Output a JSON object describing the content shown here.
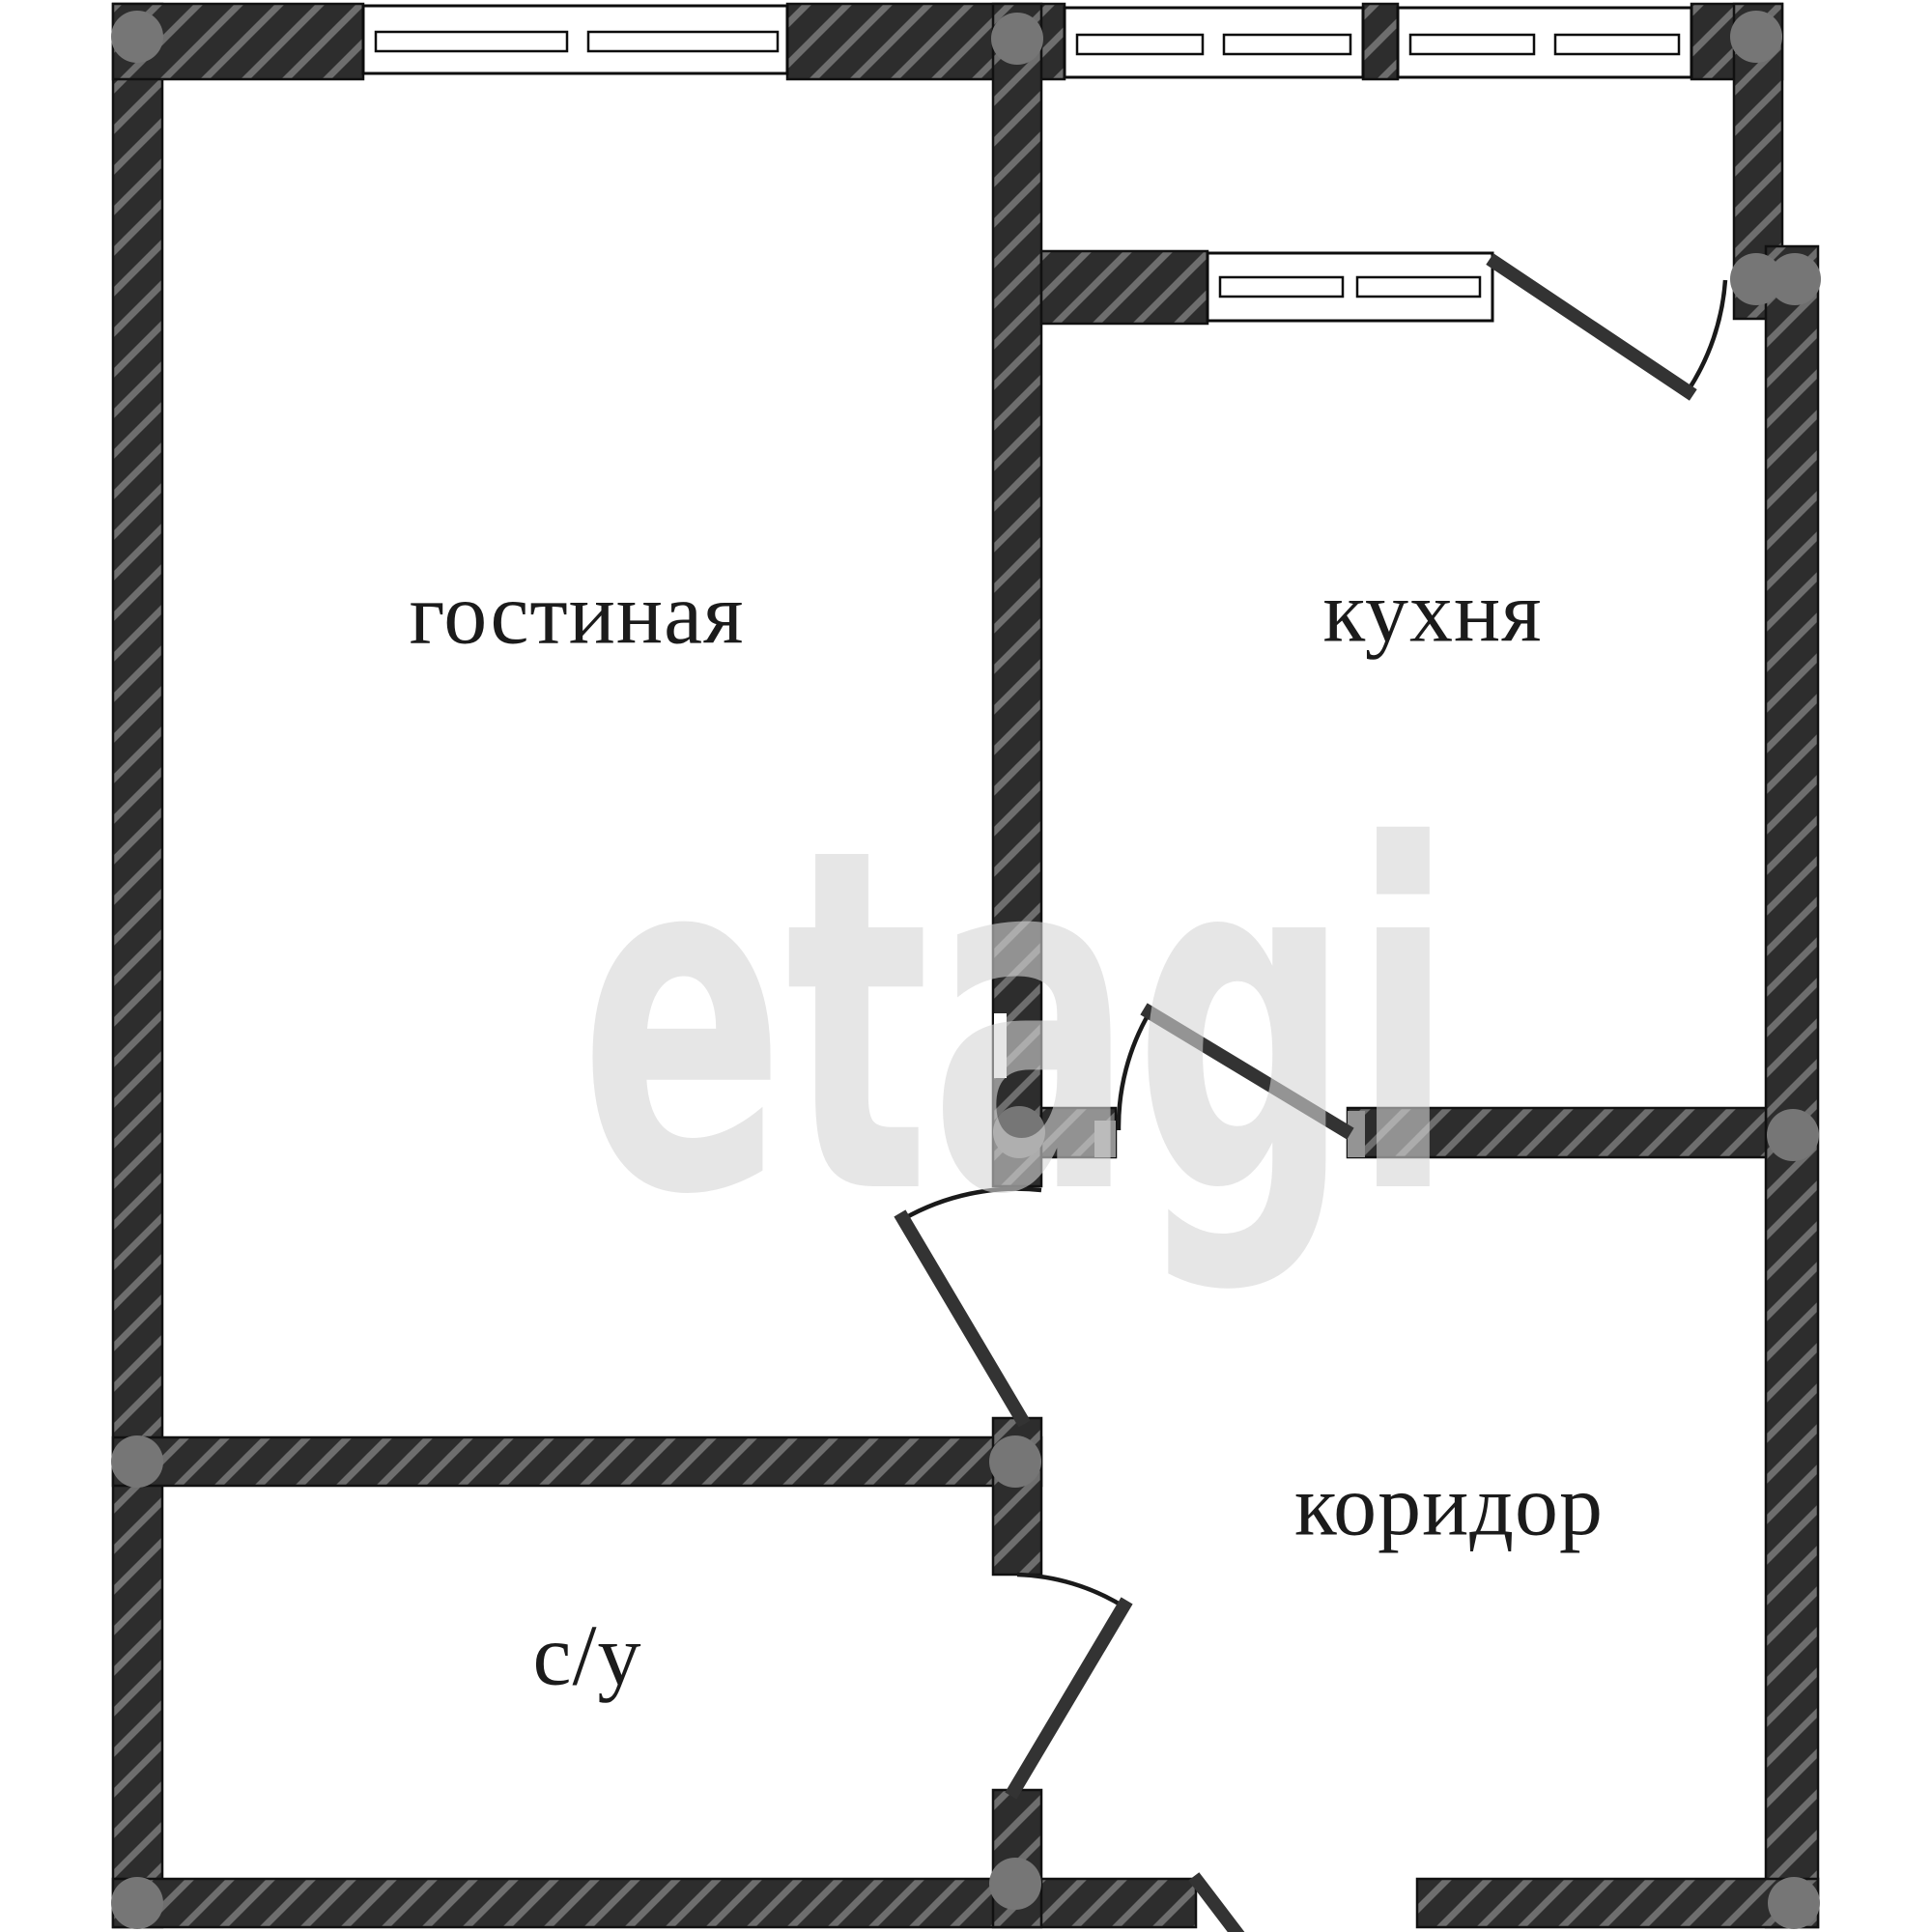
{
  "plan": {
    "type": "apartment-floor-plan",
    "rooms": [
      {
        "id": "living-room",
        "label": "гостиная"
      },
      {
        "id": "kitchen",
        "label": "кухня"
      },
      {
        "id": "corridor",
        "label": "коридор"
      },
      {
        "id": "bathroom",
        "label": "с/у"
      }
    ],
    "watermark": {
      "text": "etagi"
    },
    "colors": {
      "background": "#ffffff",
      "wall_fill": "#2d2d2d",
      "wall_hatch_stripe": "#6e6e6e",
      "wall_outline": "#111111",
      "column_marker": "#767676",
      "door_leaf": "#333333",
      "door_swing_arc": "#1a1a1a",
      "window_fill": "#ffffff",
      "window_line": "#0d0d0d",
      "door_jamb": "#949494",
      "label_text": "#1b1b1b",
      "watermark_gray": "#e7e7e7"
    }
  }
}
